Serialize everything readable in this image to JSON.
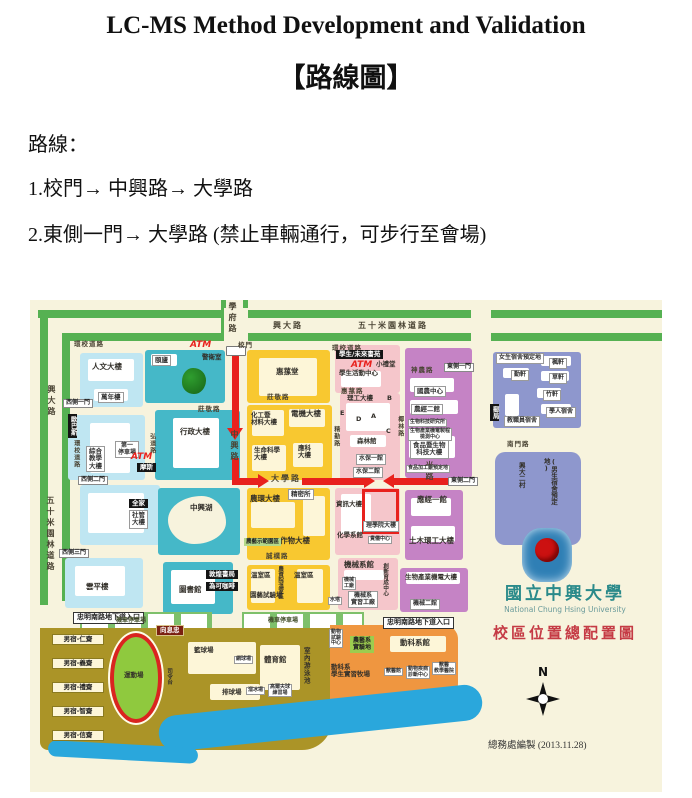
{
  "document": {
    "title": "LC-MS Method Development and Validation",
    "subtitle": "【路線圖】",
    "route_heading": "路線：",
    "route_steps": [
      "1.校門→ 中興路→ 大學路",
      "2.東側一門→ 大學路 (禁止車輛通行，可步行至會場)"
    ]
  },
  "colors": {
    "route_red": "#e8211d",
    "road_green": "#56b152",
    "map_bg": "#f7f3dd",
    "water_blue": "#2aa7dc",
    "uni_teal": "#2a8a8a",
    "map_title_red": "#c53b45"
  },
  "map": {
    "labels": [
      {
        "t": "學府路",
        "cl": "rv",
        "x": 197,
        "y": 2,
        "n": "road-xuefu"
      },
      {
        "t": "興大路",
        "cl": "rh",
        "x": 243,
        "y": 22,
        "n": "road-xingda-top"
      },
      {
        "t": "五十米園林道路",
        "cl": "rh",
        "x": 328,
        "y": 22,
        "n": "road-50m-top"
      },
      {
        "t": "環校道路",
        "cl": "rhs",
        "x": 44,
        "y": 41,
        "n": "road-ring-nw"
      },
      {
        "t": "環校道路",
        "cl": "rhs",
        "x": 302,
        "y": 45,
        "n": "road-ring-ne"
      },
      {
        "t": "校門",
        "cl": "rhs",
        "x": 208,
        "y": 42,
        "n": "main-gate-label"
      },
      {
        "t": "ATM",
        "cl": "red",
        "x": 160,
        "y": 40
      },
      {
        "t": "警衛室",
        "cl": "bls",
        "x": 172,
        "y": 54
      },
      {
        "t": "興大路",
        "cl": "rv",
        "x": 16,
        "y": 85,
        "n": "road-xingda-left"
      },
      {
        "t": "五十米園林道路",
        "cl": "rv",
        "x": 15,
        "y": 196,
        "n": "road-50m-left"
      },
      {
        "t": "中興路",
        "cl": "rv",
        "x": 199,
        "y": 130,
        "n": "road-zhongxing"
      },
      {
        "t": "大學路",
        "cl": "rh",
        "x": 241,
        "y": 175,
        "n": "road-daxue"
      },
      {
        "t": "莊敬路",
        "cl": "rhs",
        "x": 168,
        "y": 106
      },
      {
        "t": "莊敬路",
        "cl": "rhs",
        "x": 237,
        "y": 94
      },
      {
        "t": "惠蓀路",
        "cl": "rhs",
        "x": 311,
        "y": 88
      },
      {
        "t": "神農路",
        "cl": "rhs",
        "x": 381,
        "y": 67
      },
      {
        "t": "椰林路",
        "cl": "rvs",
        "x": 366,
        "y": 116
      },
      {
        "t": "精勤路",
        "cl": "rvs",
        "x": 302,
        "y": 126
      },
      {
        "t": "弘道路",
        "cl": "rvs",
        "x": 118,
        "y": 133
      },
      {
        "t": "誠樸路",
        "cl": "rhs",
        "x": 236,
        "y": 253
      },
      {
        "t": "南門路",
        "cl": "rhs",
        "x": 477,
        "y": 141
      },
      {
        "t": "國光路",
        "cl": "rv",
        "x": 394,
        "y": 150,
        "n": "road-guoguang"
      },
      {
        "t": "環校道路",
        "cl": "rvs",
        "x": 42,
        "y": 140
      },
      {
        "t": "西側一門",
        "cl": "gate",
        "x": 33,
        "y": 99
      },
      {
        "t": "西側二門",
        "cl": "gate",
        "x": 48,
        "y": 176
      },
      {
        "t": "西側三門",
        "cl": "gate",
        "x": 29,
        "y": 249
      },
      {
        "t": "東側一門",
        "cl": "gate",
        "x": 414,
        "y": 63
      },
      {
        "t": "東側二門",
        "cl": "gate",
        "x": 418,
        "y": 177
      },
      {
        "t": "忠明南路地下道入口",
        "cl": "tunnel",
        "x": 43,
        "y": 312
      },
      {
        "t": "忠明南路地下道入口",
        "cl": "tunnel",
        "x": 353,
        "y": 317
      },
      {
        "t": "人文大樓",
        "cl": "bl",
        "x": 62,
        "y": 63
      },
      {
        "t": "萬年樓",
        "cl": "box",
        "x": 68,
        "y": 92
      },
      {
        "t": "頤廬",
        "cl": "box",
        "x": 122,
        "y": 55
      },
      {
        "t": "惠蓀堂",
        "cl": "bl",
        "x": 246,
        "y": 68
      },
      {
        "t": "歐巴斯",
        "cl": "shopv",
        "x": 38,
        "y": 114
      },
      {
        "t": "綜合\n教學\n大樓",
        "cl": "box",
        "x": 56,
        "y": 146
      },
      {
        "t": "第一\n停車場",
        "cl": "boxs",
        "x": 85,
        "y": 141
      },
      {
        "t": "ATM",
        "cl": "red",
        "x": 101,
        "y": 152
      },
      {
        "t": "摩斯",
        "cl": "shop",
        "x": 107,
        "y": 163
      },
      {
        "t": "行政大樓",
        "cl": "bl",
        "x": 150,
        "y": 128
      },
      {
        "t": "全家",
        "cl": "shop",
        "x": 99,
        "y": 199
      },
      {
        "t": "社管\n大樓",
        "cl": "box",
        "x": 99,
        "y": 210
      },
      {
        "t": "中興湖",
        "cl": "bl",
        "x": 160,
        "y": 204
      },
      {
        "t": "雲平樓",
        "cl": "bl",
        "x": 56,
        "y": 283
      },
      {
        "t": "圖書館",
        "cl": "bl",
        "x": 149,
        "y": 286
      },
      {
        "t": "敦煌書局",
        "cl": "shop",
        "x": 176,
        "y": 270
      },
      {
        "t": "為可咖啡",
        "cl": "shop",
        "x": 176,
        "y": 282
      },
      {
        "t": "化工暨\n材料大樓",
        "cl": "bls",
        "x": 221,
        "y": 112
      },
      {
        "t": "電機大樓",
        "cl": "bl",
        "x": 261,
        "y": 110
      },
      {
        "t": "生命科學\n大樓",
        "cl": "bls",
        "x": 224,
        "y": 147
      },
      {
        "t": "應科\n大樓",
        "cl": "bls",
        "x": 268,
        "y": 145
      },
      {
        "t": "理工大樓",
        "cl": "bls",
        "x": 317,
        "y": 95
      },
      {
        "t": "B",
        "cl": "bls",
        "x": 357,
        "y": 95
      },
      {
        "t": "E",
        "cl": "bls",
        "x": 310,
        "y": 110
      },
      {
        "t": "D",
        "cl": "bls",
        "x": 326,
        "y": 116
      },
      {
        "t": "A",
        "cl": "bls",
        "x": 341,
        "y": 113
      },
      {
        "t": "C",
        "cl": "bls",
        "x": 356,
        "y": 128
      },
      {
        "t": "森林館",
        "cl": "bls",
        "x": 327,
        "y": 138
      },
      {
        "t": "水保一館",
        "cl": "boxs",
        "x": 326,
        "y": 154
      },
      {
        "t": "水保二館",
        "cl": "boxs",
        "x": 323,
        "y": 167
      },
      {
        "t": "學生/未來書苑",
        "cl": "shop",
        "x": 306,
        "y": 50
      },
      {
        "t": "ATM",
        "cl": "red",
        "x": 321,
        "y": 60
      },
      {
        "t": "小禮堂",
        "cl": "bls",
        "x": 346,
        "y": 61
      },
      {
        "t": "學生活動中心",
        "cl": "bls",
        "x": 309,
        "y": 70
      },
      {
        "t": "國農中心",
        "cl": "box",
        "x": 384,
        "y": 86
      },
      {
        "t": "農經二館",
        "cl": "box",
        "x": 381,
        "y": 104
      },
      {
        "t": "生物科技研究所",
        "cl": "boxxs",
        "x": 378,
        "y": 119
      },
      {
        "t": "生物產業機電製程\n檢測中心",
        "cl": "boxxs",
        "x": 378,
        "y": 128
      },
      {
        "t": "食品暨生物\n科技大樓",
        "cl": "box",
        "x": 380,
        "y": 140
      },
      {
        "t": "食品加工廠預定地",
        "cl": "boxxs",
        "x": 376,
        "y": 165
      },
      {
        "t": "女生宿舍預定地",
        "cl": "boxs",
        "x": 466,
        "y": 53
      },
      {
        "t": "楓軒",
        "cl": "boxs",
        "x": 519,
        "y": 58
      },
      {
        "t": "勤軒",
        "cl": "boxs",
        "x": 481,
        "y": 70
      },
      {
        "t": "草軒",
        "cl": "boxs",
        "x": 519,
        "y": 73
      },
      {
        "t": "竹軒",
        "cl": "boxs",
        "x": 513,
        "y": 90
      },
      {
        "t": "學人宿舍",
        "cl": "boxs",
        "x": 516,
        "y": 107
      },
      {
        "t": "教職員宿舍",
        "cl": "boxs",
        "x": 474,
        "y": 116
      },
      {
        "t": "郵局",
        "cl": "shopv",
        "x": 460,
        "y": 104
      },
      {
        "t": "興大二村",
        "cl": "blv2",
        "x": 487,
        "y": 162,
        "n": "xingda-village"
      },
      {
        "t": "(男生宿舍預定地)",
        "cl": "blv2",
        "x": 512,
        "y": 158
      },
      {
        "t": "農環大樓",
        "cl": "bl",
        "x": 220,
        "y": 195
      },
      {
        "t": "精密所",
        "cl": "box",
        "x": 258,
        "y": 189
      },
      {
        "t": "作物大樓",
        "cl": "bl",
        "x": 250,
        "y": 237
      },
      {
        "t": "農藝示範園區",
        "cl": "grnbox",
        "x": 214,
        "y": 238
      },
      {
        "t": "資訊大樓",
        "cl": "bls",
        "x": 306,
        "y": 201
      },
      {
        "t": "理學院大樓",
        "cl": "boxs",
        "x": 333,
        "y": 221,
        "n": "venue-building-label"
      },
      {
        "t": "化學系館",
        "cl": "bls",
        "x": 307,
        "y": 232
      },
      {
        "t": "貴儀中心",
        "cl": "boxxs",
        "x": 338,
        "y": 236
      },
      {
        "t": "應經一館",
        "cl": "bl",
        "x": 387,
        "y": 196
      },
      {
        "t": "土木環工大樓",
        "cl": "bl",
        "x": 379,
        "y": 237
      },
      {
        "t": "溫室區",
        "cl": "bls",
        "x": 221,
        "y": 272
      },
      {
        "t": "農資院溫室區",
        "cl": "blvxs",
        "x": 247,
        "y": 266
      },
      {
        "t": "溫室區",
        "cl": "bls",
        "x": 264,
        "y": 272
      },
      {
        "t": "園藝試驗場",
        "cl": "bls",
        "x": 220,
        "y": 292
      },
      {
        "t": "機械系館",
        "cl": "bl",
        "x": 314,
        "y": 261
      },
      {
        "t": "機械\n工廠",
        "cl": "boxxs",
        "x": 312,
        "y": 277
      },
      {
        "t": "機械系\n實習工廠",
        "cl": "boxs",
        "x": 318,
        "y": 291
      },
      {
        "t": "水塔",
        "cl": "boxxs",
        "x": 298,
        "y": 297
      },
      {
        "t": "創新育成中心",
        "cl": "blvxs",
        "x": 352,
        "y": 263
      },
      {
        "t": "生物產業機電大樓",
        "cl": "bls",
        "x": 375,
        "y": 274
      },
      {
        "t": "機械二館",
        "cl": "boxs",
        "x": 380,
        "y": 299
      },
      {
        "t": "機車停車場",
        "cl": "parkl",
        "x": 86,
        "y": 318
      },
      {
        "t": "機車停車場",
        "cl": "parkl",
        "x": 238,
        "y": 318
      },
      {
        "t": "男宿-仁齋",
        "cl": "dorm",
        "x": 22,
        "y": 334
      },
      {
        "t": "男宿-義齋",
        "cl": "dorm",
        "x": 22,
        "y": 358
      },
      {
        "t": "男宿-禮齋",
        "cl": "dorm",
        "x": 22,
        "y": 382
      },
      {
        "t": "男宿-智齋",
        "cl": "dorm",
        "x": 22,
        "y": 406
      },
      {
        "t": "男宿-信齋",
        "cl": "dorm",
        "x": 22,
        "y": 430
      },
      {
        "t": "運動場",
        "cl": "bls",
        "x": 94,
        "y": 372,
        "n": "sports-field-label"
      },
      {
        "t": "司令台",
        "cl": "blvxs",
        "x": 136,
        "y": 368
      },
      {
        "t": "向息忠",
        "cl": "shoprd",
        "x": 126,
        "y": 325
      },
      {
        "t": "籃球場",
        "cl": "bls",
        "x": 164,
        "y": 347
      },
      {
        "t": "網球場",
        "cl": "boxxs",
        "x": 204,
        "y": 356
      },
      {
        "t": "體育館",
        "cl": "bl",
        "x": 234,
        "y": 356
      },
      {
        "t": "室內游泳池",
        "cl": "blv",
        "x": 272,
        "y": 347
      },
      {
        "t": "排球場",
        "cl": "bls",
        "x": 192,
        "y": 389
      },
      {
        "t": "溜冰場",
        "cl": "boxxs",
        "x": 216,
        "y": 387
      },
      {
        "t": "高爾夫球\n練習場",
        "cl": "boxxs",
        "x": 238,
        "y": 384
      },
      {
        "t": "動物\n試驗\n中心",
        "cl": "boxxs",
        "x": 299,
        "y": 329
      },
      {
        "t": "農藝系\n實驗地",
        "cl": "grnbox2",
        "x": 320,
        "y": 336
      },
      {
        "t": "動科系館",
        "cl": "bl",
        "x": 370,
        "y": 339
      },
      {
        "t": "動科系\n學生實習牧場",
        "cl": "bls",
        "x": 301,
        "y": 364
      },
      {
        "t": "獸醫館",
        "cl": "boxxs",
        "x": 354,
        "y": 368
      },
      {
        "t": "動物疾病\n診斷中心",
        "cl": "boxxs",
        "x": 376,
        "y": 366
      },
      {
        "t": "獸醫\n教學醫院",
        "cl": "boxxs",
        "x": 402,
        "y": 362
      },
      {
        "t": "國立中興大學",
        "cl": "uniname",
        "x": 450,
        "y": 284,
        "n": "university-name"
      },
      {
        "t": "National Chung Hsing University",
        "cl": "unieng",
        "x": 450,
        "y": 306,
        "n": "university-name-en"
      },
      {
        "t": "校區位置總配置圖",
        "cl": "maptitle",
        "x": 445,
        "y": 325,
        "n": "map-title"
      },
      {
        "t": "N",
        "cl": "compassN",
        "x": 508,
        "y": 366,
        "n": "compass-north-label"
      },
      {
        "t": "總務處編製 (2013.11.28)",
        "cl": "credit",
        "x": 458,
        "y": 441,
        "n": "map-credit"
      }
    ]
  }
}
